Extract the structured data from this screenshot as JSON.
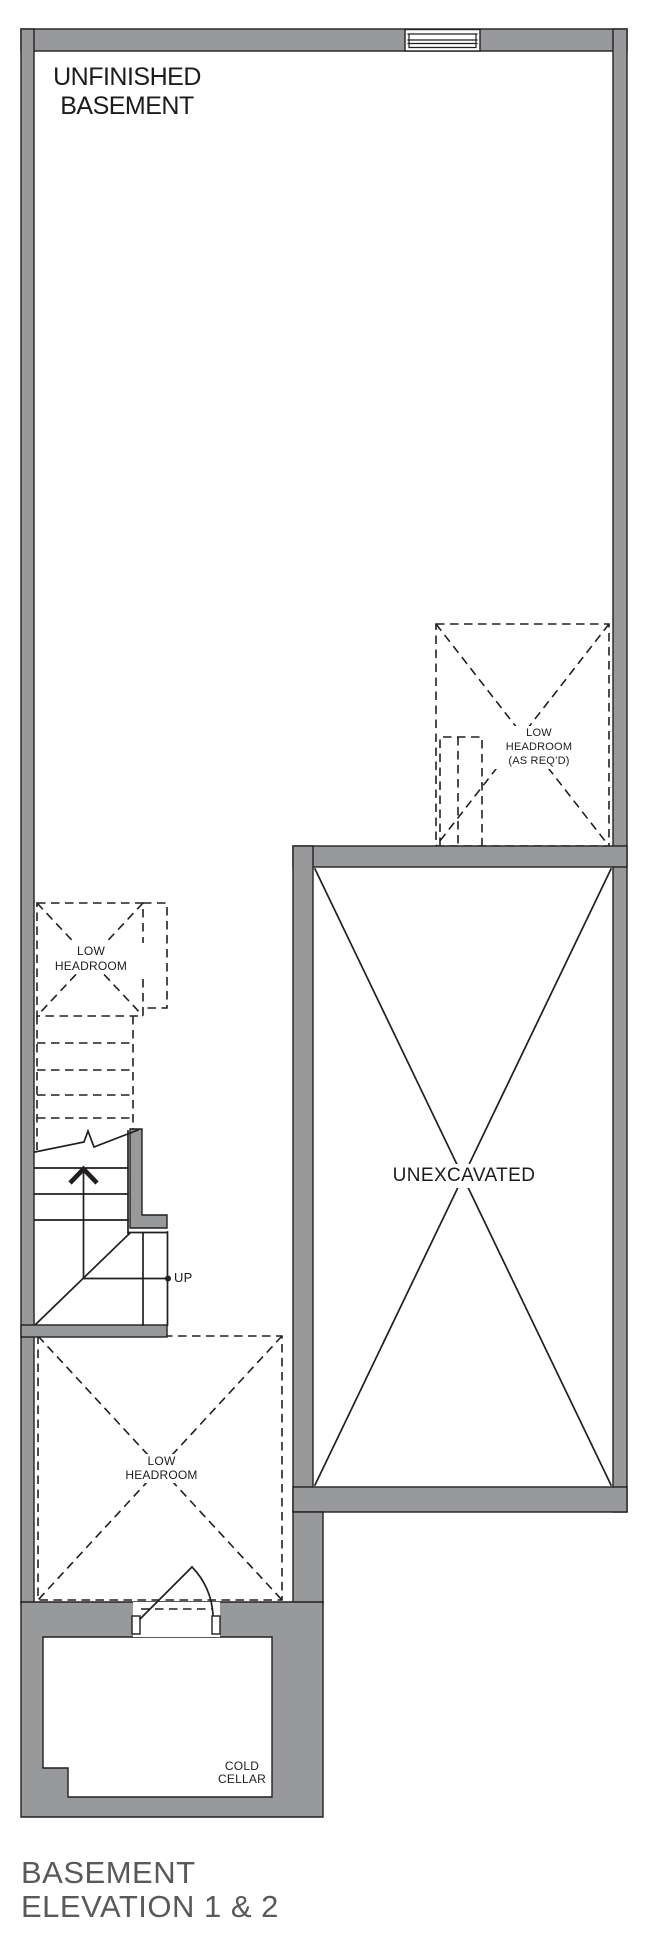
{
  "drawing": {
    "plan_title": "BASEMENT",
    "plan_subtitle": "ELEVATION 1 & 2"
  },
  "labels": {
    "unfinished_basement": "UNFINISHED\nBASEMENT",
    "low_headroom_as_reqd": "LOW\nHEADROOM\n(AS REQ’D)",
    "low_headroom_stairs": "LOW\nHEADROOM",
    "unexcavated": "UNEXCAVATED",
    "stairs_direction": "UP",
    "low_headroom_garage": "LOW\nHEADROOM",
    "cold_cellar": "COLD\nCELLAR"
  },
  "colors": {
    "wall_fill": "#97999B",
    "line_color": "#231F20",
    "title_color": "#58595B",
    "label_color": "#1C1C1C"
  }
}
